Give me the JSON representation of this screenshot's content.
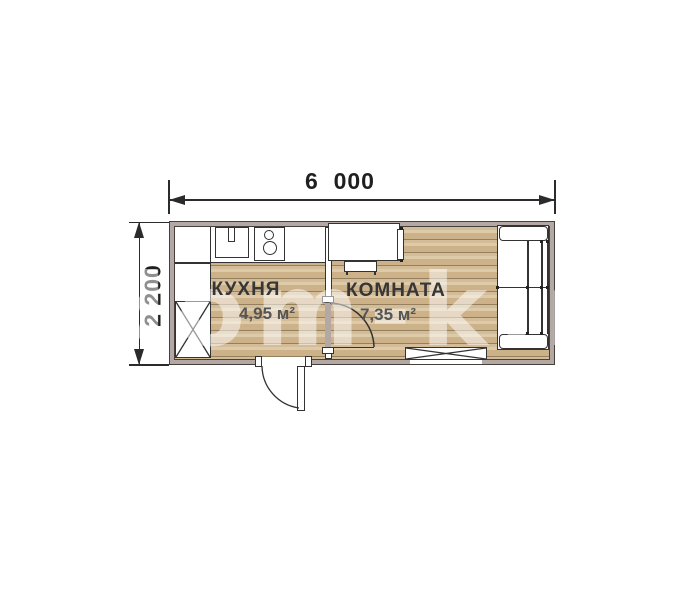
{
  "title": "cabin-floor-plan",
  "dimensions": {
    "width_label": "6  000",
    "height_label": "2 200"
  },
  "rooms": {
    "kitchen": {
      "name": "КУХНЯ",
      "area": "4,95 м²"
    },
    "room": {
      "name": "КОМНАТА",
      "area": "7,35 м²"
    }
  },
  "watermark": "dom-k.ru",
  "colors": {
    "wall_fill": "#b3a8a3",
    "wall_line": "#45403c",
    "floor_wood": "#ccb189",
    "plank_line": "#92805f",
    "drawing_line": "#333333",
    "label_dark": "#363636",
    "label_gray": "#555555"
  }
}
